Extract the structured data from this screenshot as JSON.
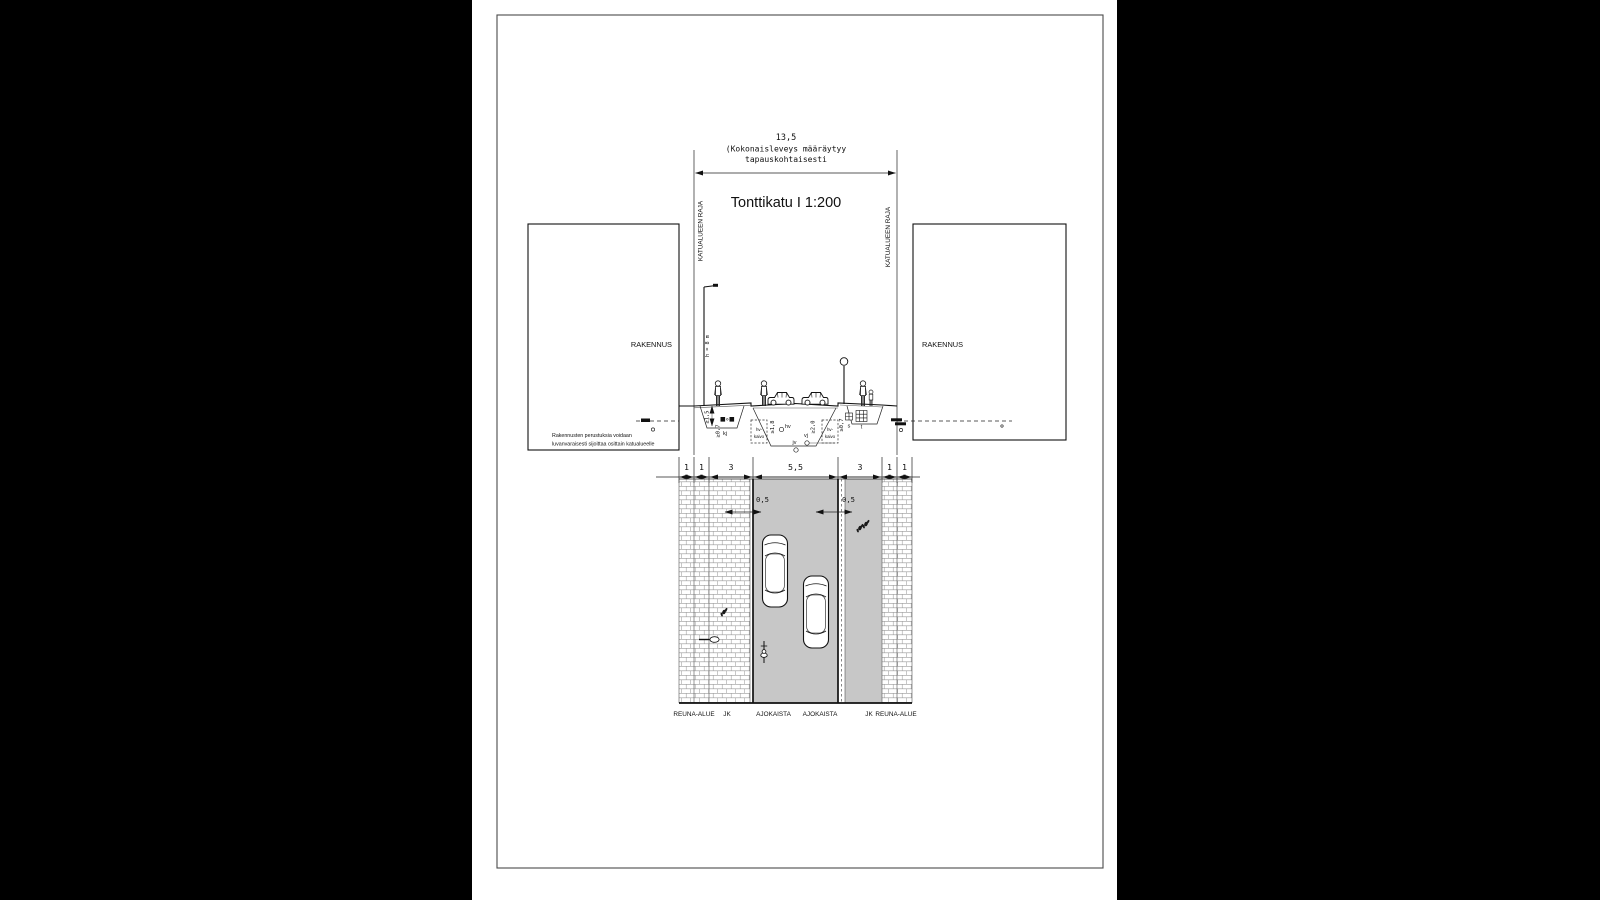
{
  "texts": {
    "title": "Tonttikatu I 1:200",
    "dim_total": "13,5",
    "dim_note1": "(Kokonaisleveys määräytyy",
    "dim_note2": "tapauskohtaisesti",
    "raja": "KATUALUEEN RAJA",
    "building": "RAKENNUS",
    "found1": "Rakennusten perustuksia voidaan",
    "found2": "luvanvaraisesti sijoittaa osittain katualueelle",
    "lamp": "h = 8 m"
  },
  "section": {
    "d07": "≥0,7",
    "d15": "≥1,5",
    "d18": "≥1,8",
    "d20": "≥2,0",
    "kj": "kj",
    "hv": "hv",
    "jv": "jv",
    "vj": "vj",
    "s": "s",
    "t": "t",
    "kaivo1": "hv-",
    "kaivo2": "kaivo"
  },
  "plan": {
    "dims": [
      "1",
      "1",
      "3",
      "5,5",
      "3",
      "1",
      "1"
    ],
    "offset": "0,5",
    "zones": [
      "REUNA-ALUE",
      "JK",
      "AJOKAISTA",
      "AJOKAISTA",
      "JK",
      "REUNA-ALUE"
    ]
  },
  "colors": {
    "asphalt": "#c7c7c7",
    "line": "#111111",
    "brick_line": "#9a9a9a"
  }
}
